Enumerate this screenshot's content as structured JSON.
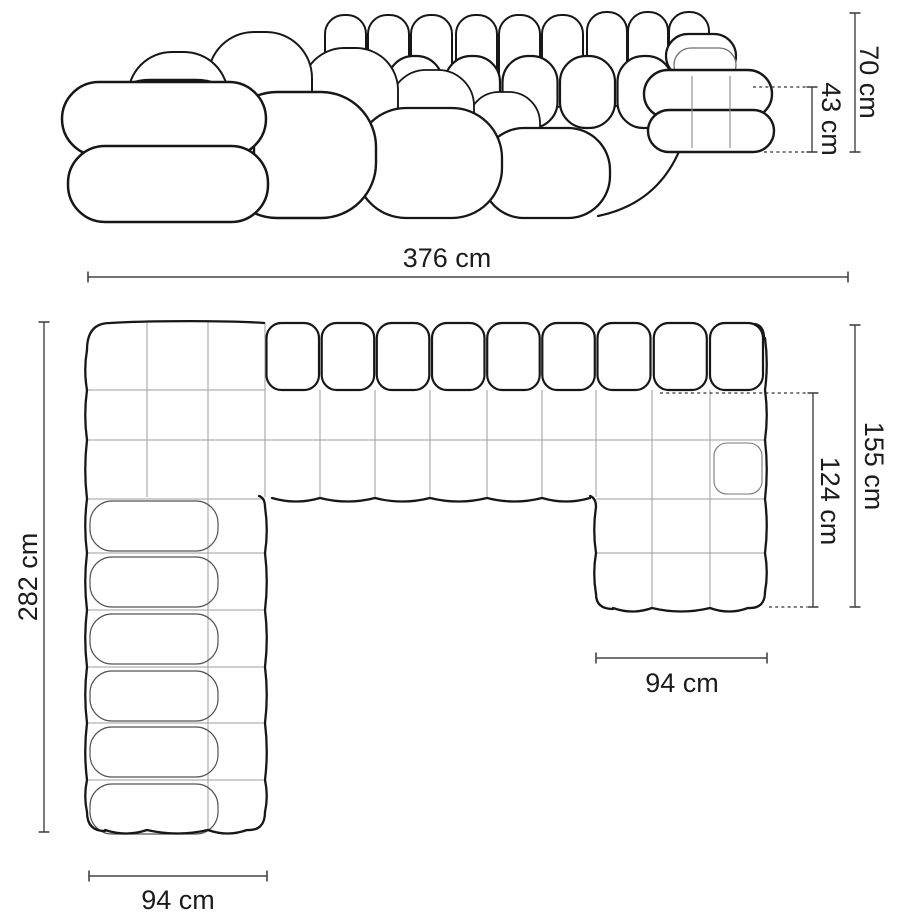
{
  "diagram": {
    "type": "furniture-dimension-diagram",
    "subject": "modular U-shaped tufted sofa",
    "views": [
      {
        "name": "front-elevation"
      },
      {
        "name": "top-plan"
      }
    ],
    "dimensions": {
      "height_total": "70 cm",
      "seat_height": "43 cm",
      "width_total": "376 cm",
      "depth_total": "282 cm",
      "right_chaise_length": "155 cm",
      "right_chaise_inner_length": "124 cm",
      "right_chaise_width": "94 cm",
      "left_chaise_width": "94 cm"
    },
    "colors": {
      "outline": "#171717",
      "inner_line": "#6e6e6e",
      "grid_line": "#9e9e9e",
      "dimension_line": "#444444",
      "label_text": "#1c1c1c",
      "background": "#ffffff"
    }
  }
}
